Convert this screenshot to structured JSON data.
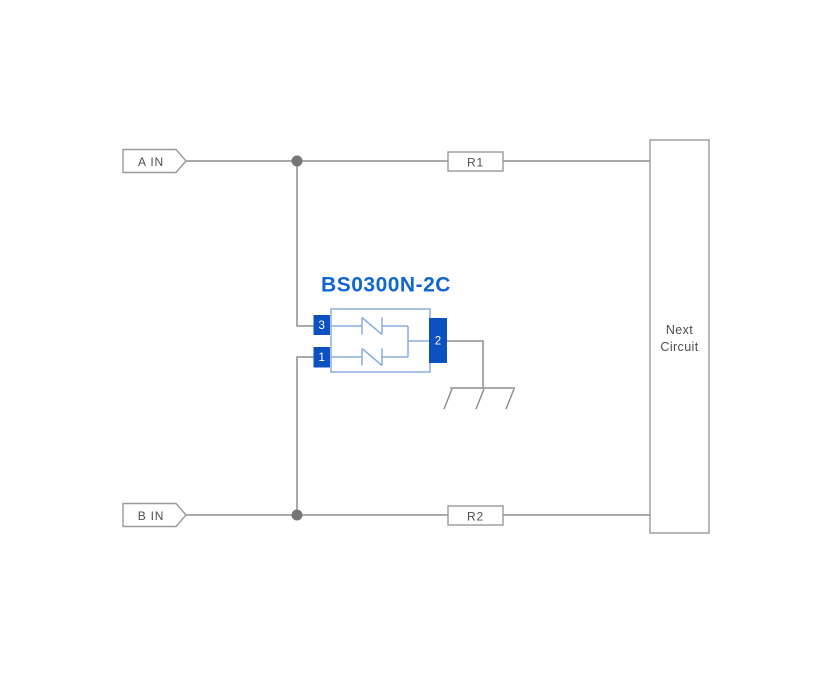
{
  "diagram": {
    "component": {
      "title": "BS0300N-2C",
      "pins": [
        {
          "number": "3"
        },
        {
          "number": "1"
        },
        {
          "number": "2"
        }
      ],
      "internal_elements": "two bidirectional TVS diodes to common pin 2"
    },
    "inputs": [
      {
        "label": "A IN"
      },
      {
        "label": "B IN"
      }
    ],
    "resistors": [
      {
        "label": "R1"
      },
      {
        "label": "R2"
      }
    ],
    "next_circuit": {
      "lines": [
        "Next",
        "Circuit"
      ]
    },
    "icons": {
      "ground": "earth-ground-hatched-bar",
      "junction": "filled-circle-node",
      "input_flag": "pointed-net-flag"
    },
    "colors": {
      "wire": "#8e8e8e",
      "boxline": "#9a9a9a",
      "junction": "#757575",
      "label": "#4f4f4f",
      "title": "#1166d1",
      "accent": "#0d50c0",
      "outline": "#8badde",
      "background": "#ffffff"
    }
  }
}
